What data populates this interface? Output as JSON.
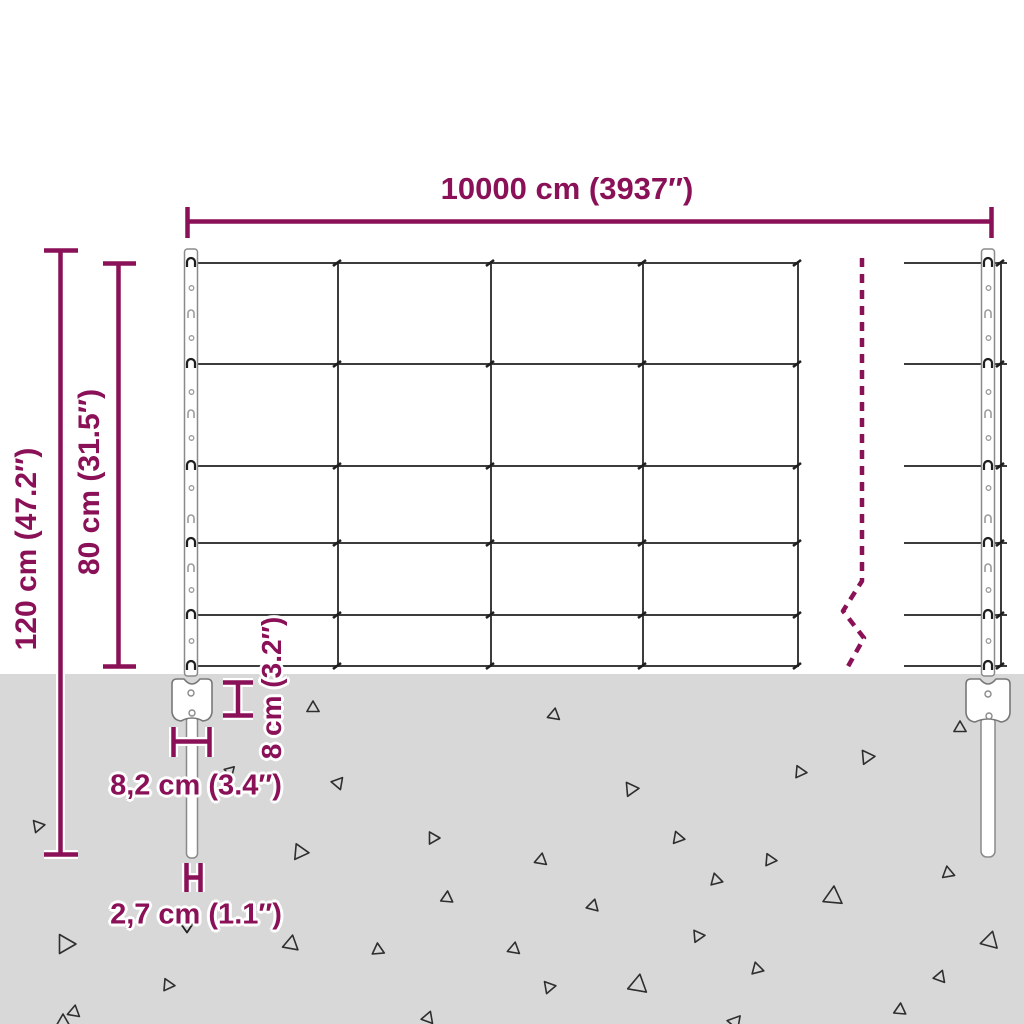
{
  "diagram": {
    "type": "fence-dimension-diagram",
    "colors": {
      "accent": "#8a1157",
      "wire": "#3c3c3c",
      "wire_dark": "#1f1f1f",
      "ground": "#d8d8d8",
      "post_stroke": "#8a8a8a",
      "detail_stroke": "#9c9c9c",
      "triangle_stroke": "#2e2e2e",
      "casing": "#ffffff"
    },
    "labels": {
      "total_width": "10000 cm (3937″)",
      "total_height": "120 cm (47.2″)",
      "mesh_height": "80 cm (31.5″)",
      "anchor_depth": "8 cm (3.2″)",
      "anchor_width": "8,2 cm (3.4″)",
      "post_diameter": "2,7 cm (1.1″)"
    },
    "geometry": {
      "ground_top": 674,
      "mesh": {
        "rows": [
          263,
          364,
          466,
          543,
          615,
          666
        ],
        "cols": [
          338,
          491,
          643,
          798
        ],
        "edge_col": 1001,
        "left": 188,
        "right": 799,
        "stub_left": 904,
        "stub_right": 1007,
        "v_top": 262,
        "v_bottom": 667
      },
      "break_line": {
        "points": [
          [
            862,
            258
          ],
          [
            862,
            581
          ],
          [
            843,
            611
          ],
          [
            864,
            638
          ],
          [
            846,
            670
          ]
        ],
        "dash": "9 7"
      },
      "posts": [
        {
          "cx": 191,
          "w": 13,
          "top": 249,
          "bottom": 676,
          "hooks": [
            263,
            364,
            466,
            543,
            615,
            666
          ],
          "slots": [
            313,
            413,
            518,
            567
          ],
          "holes": [
            288,
            338,
            392,
            438,
            488,
            590,
            641
          ]
        },
        {
          "cx": 988,
          "w": 13,
          "top": 249,
          "bottom": 676,
          "hooks": [
            263,
            364,
            466,
            543,
            615,
            666
          ],
          "slots": [
            313,
            413,
            518,
            567
          ],
          "holes": [
            288,
            338,
            392,
            438,
            488,
            590,
            641
          ]
        }
      ],
      "spikes": [
        {
          "x": 186.5,
          "w": 11,
          "top": 716,
          "bottom": 858
        },
        {
          "x": 981,
          "w": 14,
          "top": 716,
          "bottom": 857
        }
      ],
      "anchors": [
        {
          "cx": 192,
          "x0": 172,
          "x1": 212,
          "top": 679,
          "bottom": 722,
          "holes": [
            [
              191,
              693
            ],
            [
              192,
              713
            ]
          ]
        },
        {
          "cx": 988,
          "x0": 966,
          "x1": 1010,
          "top": 679,
          "bottom": 723,
          "holes": [
            [
              988,
              694
            ],
            [
              989,
              716
            ]
          ]
        }
      ],
      "dimension_lines": {
        "total-width": [
          [
            187,
            221.5,
            993,
            221.5
          ],
          [
            187.5,
            207,
            187.5,
            238
          ],
          [
            991.5,
            207,
            991.5,
            238
          ]
        ],
        "total-height": [
          [
            60.5,
            250,
            60.5,
            855
          ],
          [
            44,
            250.5,
            78,
            250.5
          ],
          [
            44,
            854.5,
            78,
            854.5
          ]
        ],
        "mesh-height": [
          [
            118.5,
            263,
            118.5,
            667
          ],
          [
            103,
            263.5,
            136,
            263.5
          ],
          [
            103,
            666.5,
            136,
            666.5
          ]
        ],
        "anchor-depth": [
          [
            238,
            682,
            238,
            716
          ],
          [
            223,
            682.5,
            253,
            682.5
          ],
          [
            223,
            715.5,
            253,
            715.5
          ]
        ],
        "anchor-width": [
          [
            174,
            741.5,
            210,
            741.5
          ],
          [
            173.5,
            727,
            173.5,
            757
          ],
          [
            209.5,
            727,
            209.5,
            757
          ]
        ],
        "post-diameter": [
          [
            187,
            877.5,
            201,
            877.5
          ],
          [
            186.5,
            863,
            186.5,
            892
          ],
          [
            200.5,
            863,
            200.5,
            892
          ]
        ]
      },
      "down_arrow": "M 181,924 L 187,932.5 L 193,923.5",
      "triangles": [
        [
          313,
          708,
          7,
          0
        ],
        [
          554,
          715,
          7,
          10
        ],
        [
          960,
          728,
          7,
          0
        ],
        [
          867,
          757,
          8,
          85
        ],
        [
          800,
          772,
          7,
          95
        ],
        [
          338,
          783,
          7,
          40
        ],
        [
          631,
          789,
          8,
          205
        ],
        [
          38,
          826,
          7,
          80
        ],
        [
          230,
          771,
          6,
          45
        ],
        [
          300,
          852,
          9,
          215
        ],
        [
          433,
          838,
          7,
          90
        ],
        [
          678,
          838,
          7,
          100
        ],
        [
          541,
          860,
          7,
          250
        ],
        [
          770,
          860,
          7,
          95
        ],
        [
          716,
          880,
          7,
          105
        ],
        [
          948,
          873,
          7,
          230
        ],
        [
          447,
          898,
          7,
          5
        ],
        [
          593,
          906,
          7,
          255
        ],
        [
          833,
          897,
          11,
          245
        ],
        [
          65,
          944,
          11,
          210
        ],
        [
          291,
          944,
          9,
          250
        ],
        [
          378,
          950,
          7,
          235
        ],
        [
          514,
          949,
          7,
          10
        ],
        [
          698,
          936,
          7,
          325
        ],
        [
          168,
          985,
          7,
          95
        ],
        [
          549,
          987,
          7,
          320
        ],
        [
          638,
          985,
          11,
          250
        ],
        [
          757,
          969,
          7,
          105
        ],
        [
          940,
          977,
          7,
          260
        ],
        [
          900,
          1010,
          7,
          245
        ],
        [
          990,
          941,
          10,
          255
        ],
        [
          74,
          1012,
          7,
          250
        ],
        [
          428,
          1018,
          7,
          260
        ],
        [
          63,
          1022,
          8,
          0
        ],
        [
          735,
          1022,
          8,
          40
        ]
      ]
    }
  }
}
